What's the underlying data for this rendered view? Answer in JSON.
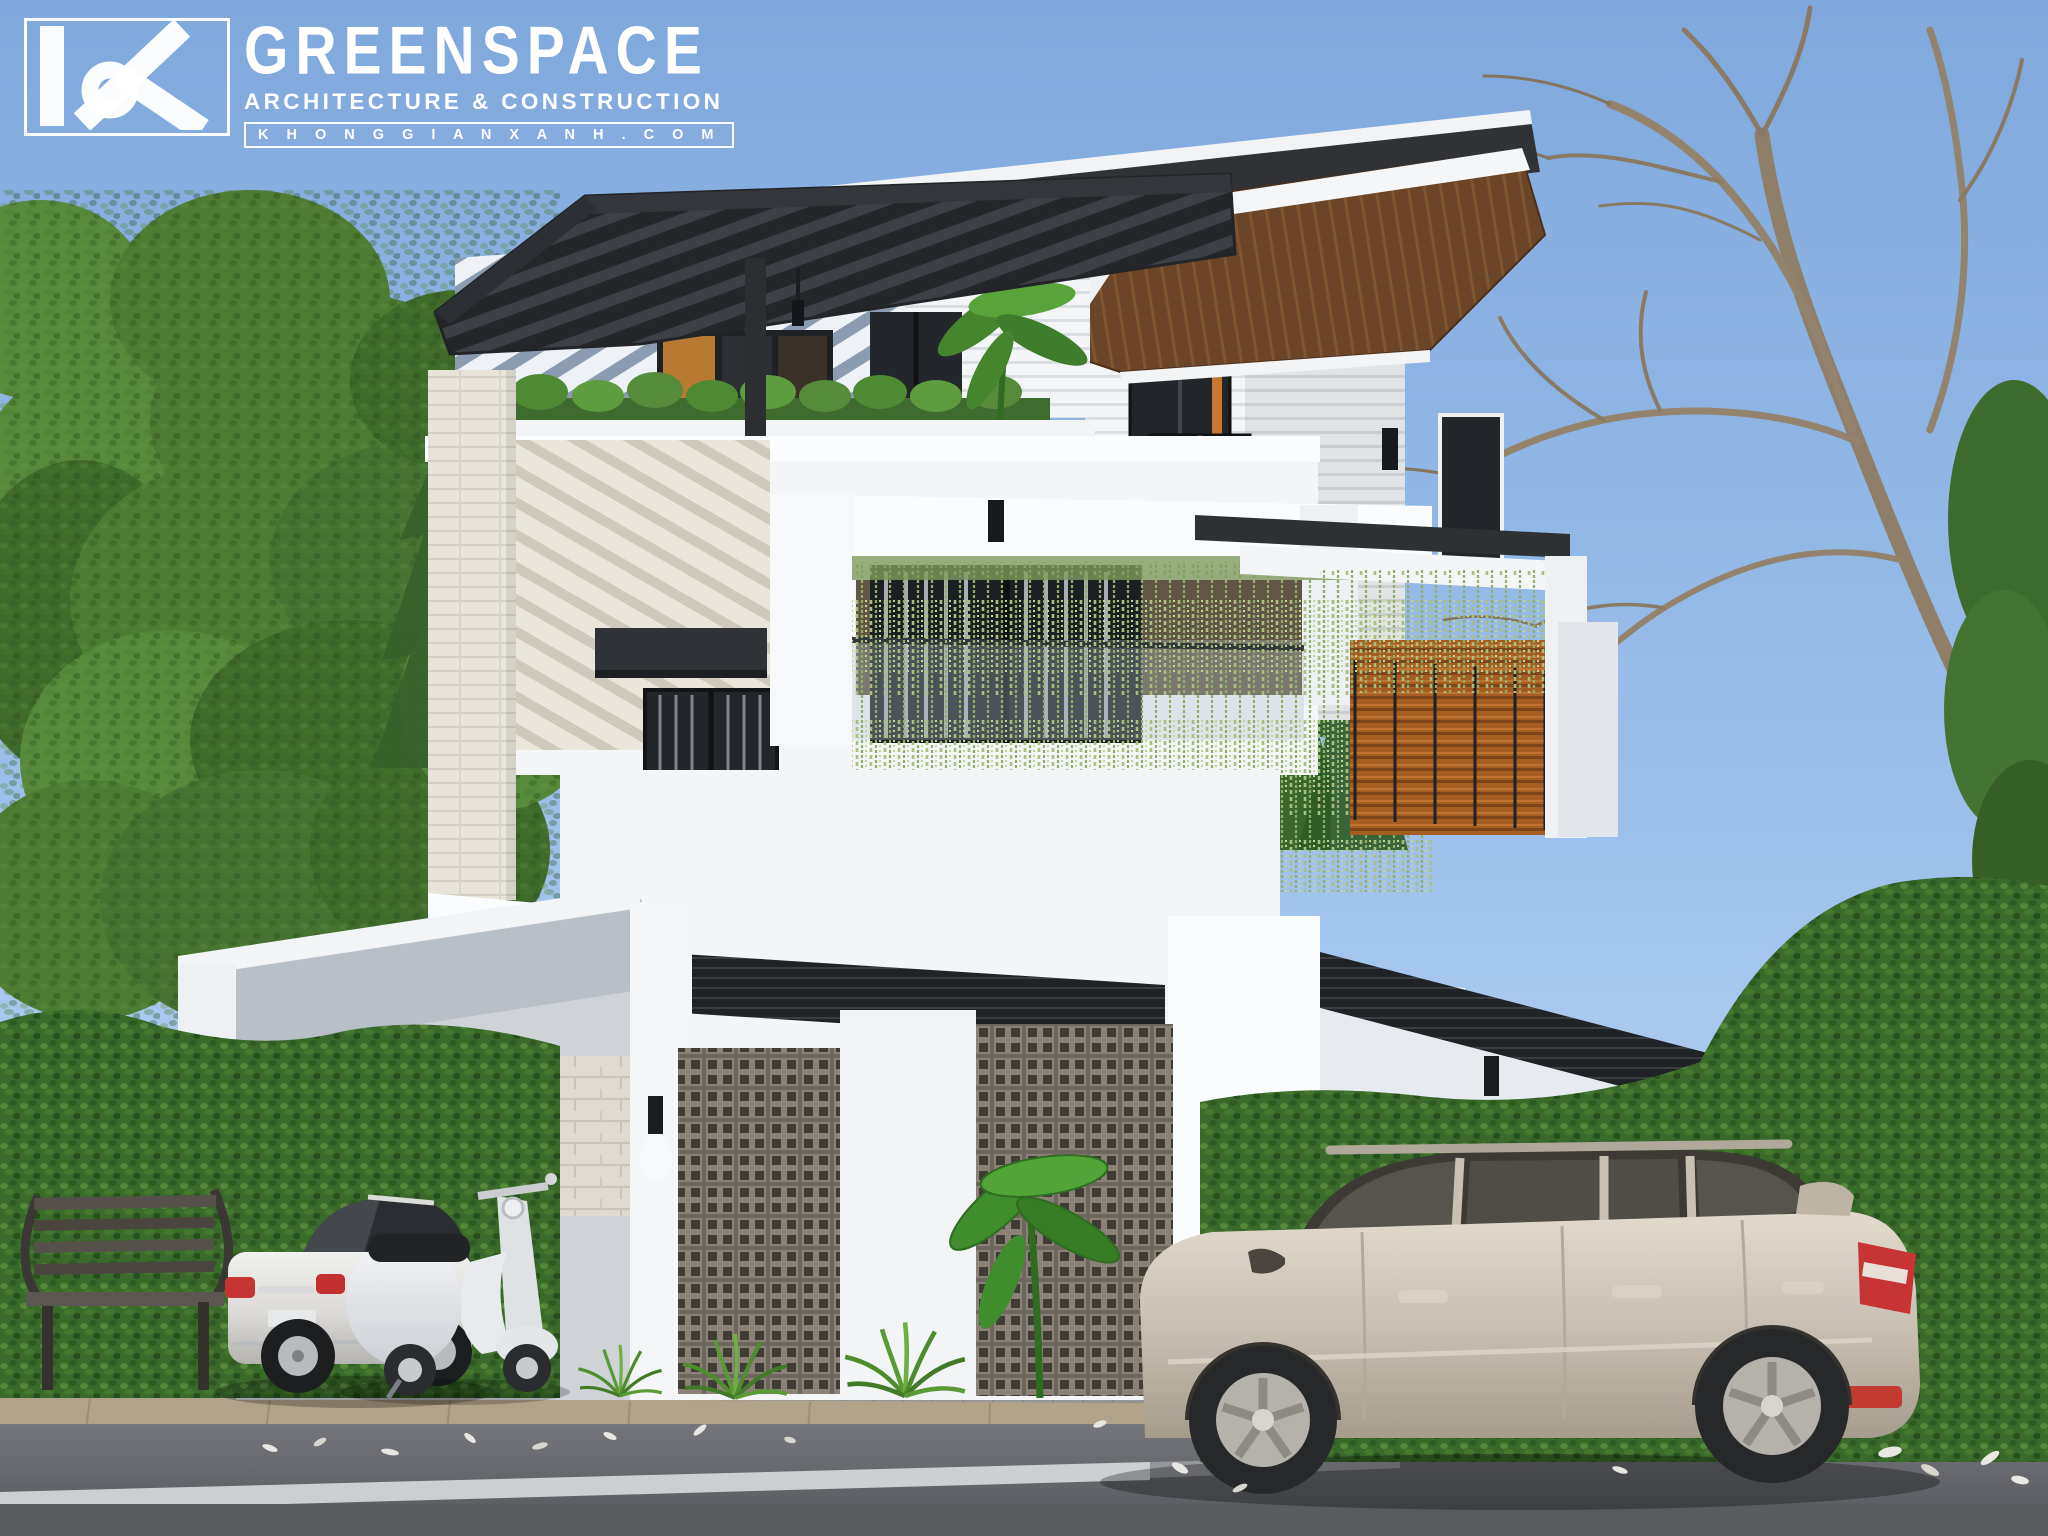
{
  "meta": {
    "title": "Modern 3-storey villa exterior - daytime architectural rendering"
  },
  "logo": {
    "monogram": "KX",
    "brand": "GREENSPACE",
    "tagline": "ARCHITECTURE & CONSTRUCTION",
    "website": "K H O N G G I A N X A N H . C O M"
  },
  "scene": {
    "time_of_day": "day",
    "objects": [
      "louvered-pergola-roof",
      "striped-feature-walls",
      "hanging-vine-balcony",
      "breeze-block-panels",
      "carport-gate",
      "park-bench",
      "white-sedan",
      "white-scooter",
      "silver-suv",
      "street-with-lane-line",
      "green-hedges",
      "trees"
    ]
  },
  "colors": {
    "sky_top": "#7fa8dc",
    "sky_mid": "#9dc1ec",
    "sky_low": "#c9dcf4",
    "wall_white": "#f3f5f7",
    "wall_bright": "#fbfcfe",
    "stripe_blue": "#8b9cb0",
    "siding_line": "#d9dee3",
    "beige_wall": "#eae6dc",
    "pergola_dark": "#24262a",
    "pergola_gap": "#3d4147",
    "wood_roof": "#6b4527",
    "wood_slat": "#a65d22",
    "vine_green": "#9db47a",
    "plant_green": "#4e8a33",
    "hedge_green": "#3a6a2a",
    "breeze_taupe": "#8b8177",
    "breeze_hole": "#3f3b35",
    "stone_tile": "#dedacf",
    "asphalt": "#64666b",
    "curb_tan": "#b1a28a",
    "paver_gray": "#94969b",
    "suv_body": "#c9c0b4",
    "sedan_body": "#dcdad6",
    "taillight_red": "#c63434",
    "window_dark": "#22252a",
    "trunk_brown": "#6d5640",
    "branch_tan": "#93836c"
  }
}
